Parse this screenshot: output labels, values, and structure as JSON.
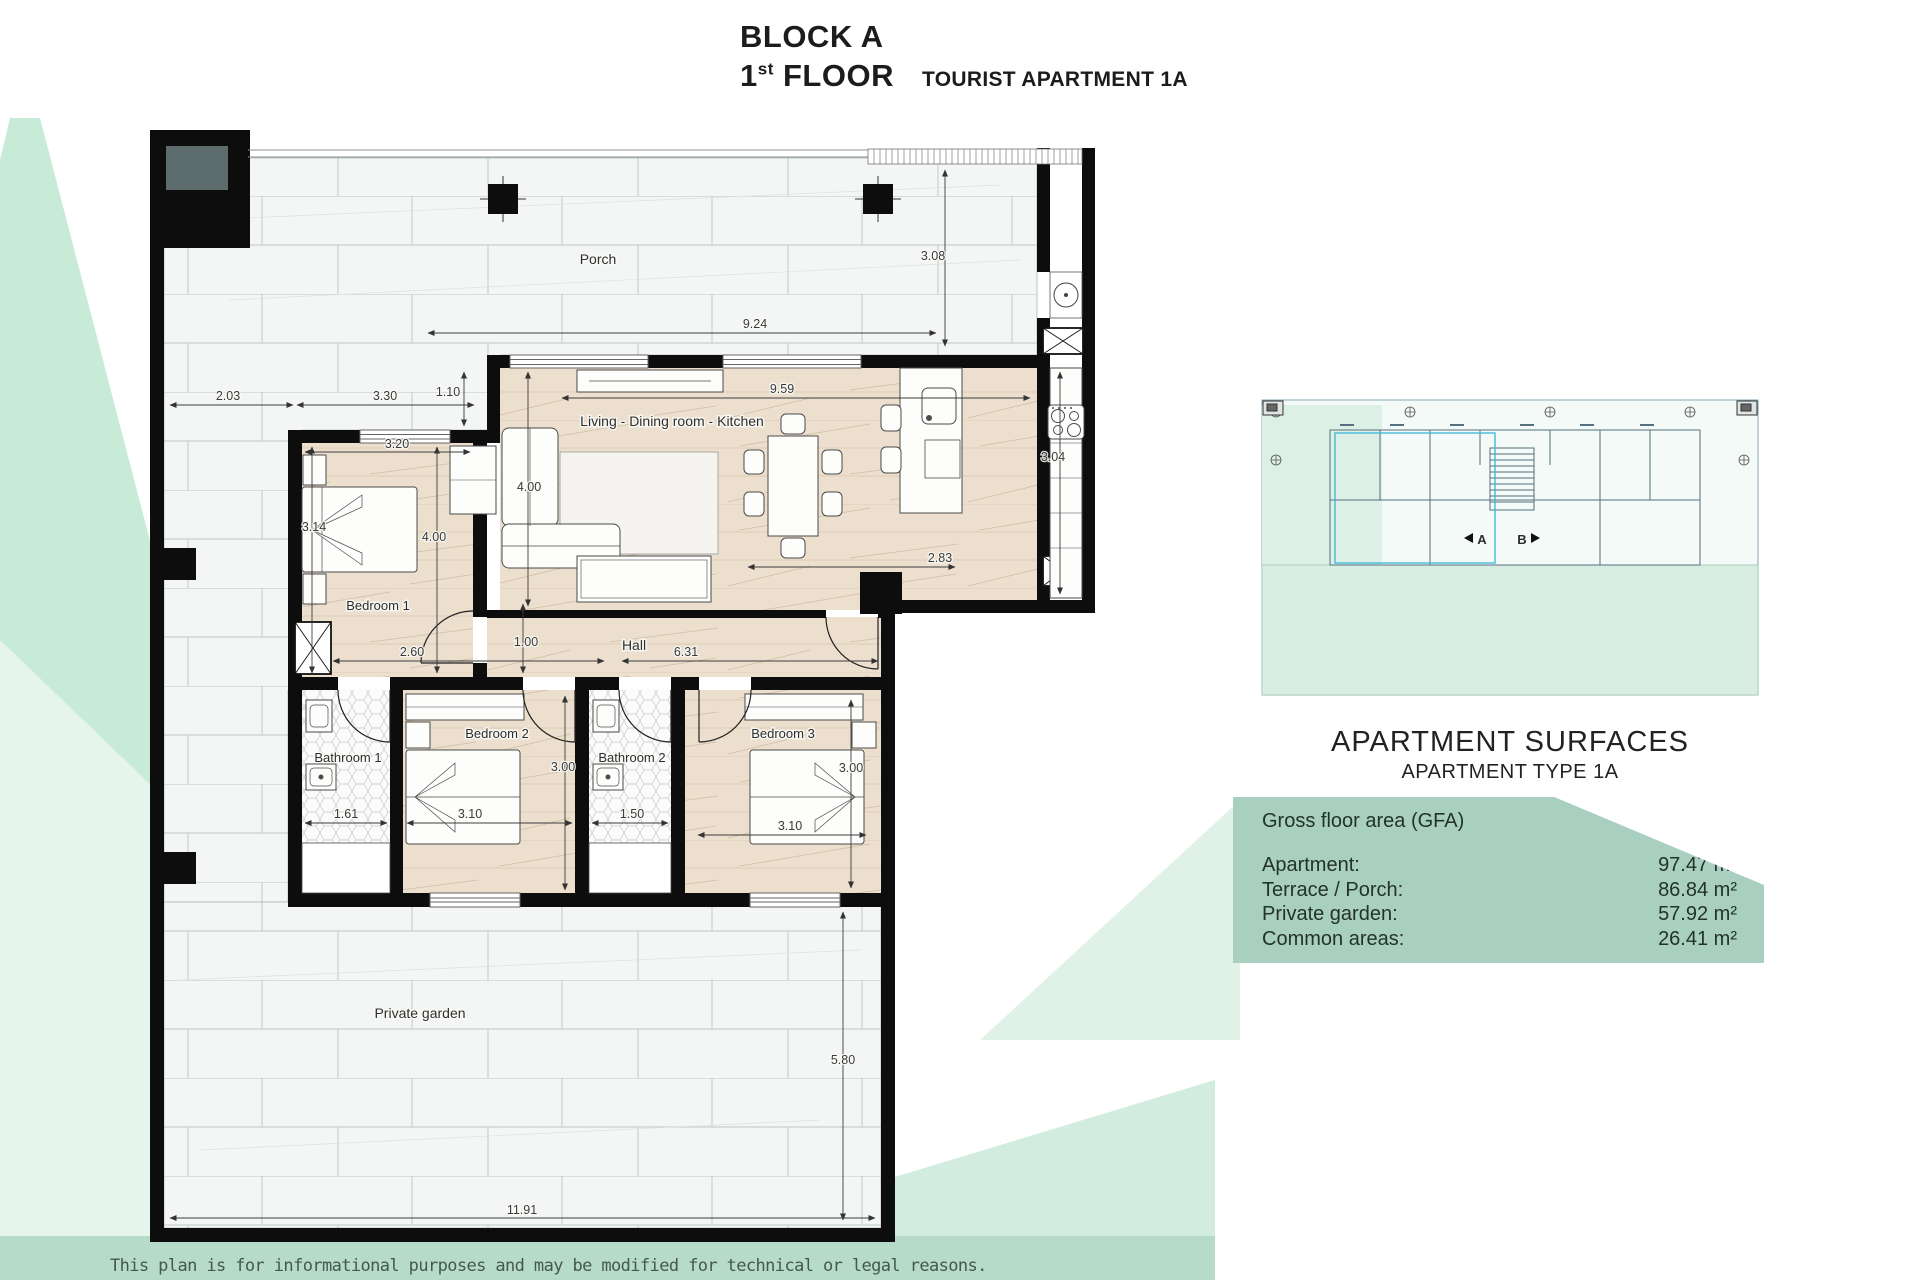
{
  "title": {
    "block": "BLOCK A",
    "floor_num": "1",
    "floor_sup": "st",
    "floor_word": "FLOOR",
    "apartment": "TOURIST APARTMENT 1A"
  },
  "plan": {
    "rooms": {
      "porch": "Porch",
      "living": "Living - Dining room - Kitchen",
      "hall": "Hall",
      "bedroom1": "Bedroom 1",
      "bedroom2": "Bedroom 2",
      "bedroom3": "Bedroom 3",
      "bathroom1": "Bathroom 1",
      "bathroom2": "Bathroom 2",
      "garden": "Private garden"
    },
    "dims": {
      "side_left": "2.03",
      "bed1_block": "3.30",
      "offset": "1.10",
      "porch_width": "9.24",
      "porch_depth": "3.08",
      "living_width": "9.59",
      "living_depth": "4.00",
      "bed1_width": "3.20",
      "bed1_depth": "4.00",
      "bed1_left": "3.14",
      "bed1_bottom": "2.60",
      "hall_width": "1.00",
      "hall_length": "6.31",
      "bed2_depth": "3.00",
      "bath1_width": "1.61",
      "bed2_width": "3.10",
      "bath2_width": "1.50",
      "bed3_width": "3.10",
      "bed3_depth": "3.00",
      "kitchen_gap": "2.83",
      "kitchen_run": "3.04",
      "garden_depth": "5.80",
      "garden_width": "11.91"
    }
  },
  "key_plan": {
    "unit_a": "A",
    "unit_b": "B"
  },
  "surfaces": {
    "title": "APARTMENT SURFACES",
    "subtitle": "APARTMENT TYPE 1A",
    "gfa_label": "Gross floor area (GFA)",
    "rows": [
      {
        "label": "Apartment:",
        "value": "97.47 m²"
      },
      {
        "label": "Terrace / Porch:",
        "value": "86.84 m²"
      },
      {
        "label": "Private garden:",
        "value": "57.92 m²"
      },
      {
        "label": "Common areas:",
        "value": "26.41 m²"
      }
    ]
  },
  "disclaimer": "This plan is for informational purposes and may be modified for technical or legal reasons.",
  "colors": {
    "mint": "#c8ebd8",
    "mint_pale": "#e6f5ec",
    "band": "#b6dbc8",
    "panel": "#a8cfc0",
    "wood": "#ecdfce",
    "tile": "#f3f6f4",
    "wall": "#0d0d0d"
  }
}
